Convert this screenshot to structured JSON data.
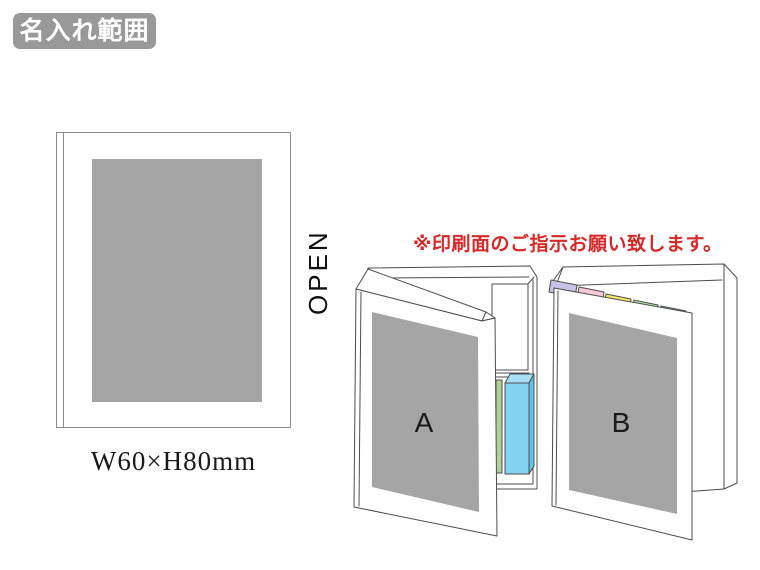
{
  "badge": {
    "label": "名入れ範囲"
  },
  "print_area_panel": {
    "open_label": "OPEN",
    "size_label": "W60×H80mm"
  },
  "instruction_note": {
    "text": "※印刷面のご指示お願い致します。"
  },
  "books": {
    "a": {
      "label": "A"
    },
    "b": {
      "label": "B"
    }
  },
  "colors": {
    "badge_bg": "#999999",
    "print_area_gray": "#a5a5a5",
    "note_red": "#d42a2a",
    "outline": "#4d4d4d",
    "cover_white": "#ffffff",
    "pad_blue": "#82d2f2",
    "pad_blue_top": "#a8dff6",
    "pad_blue_side": "#5fc3e6",
    "pad_green": "#b6cf97",
    "tab_lavender": "#c7c3e5",
    "tab_pink": "#f7cad9",
    "tab_yellow": "#f5e468",
    "tab_green": "#b5dfb0",
    "tab_blue": "#a9d9f2"
  }
}
